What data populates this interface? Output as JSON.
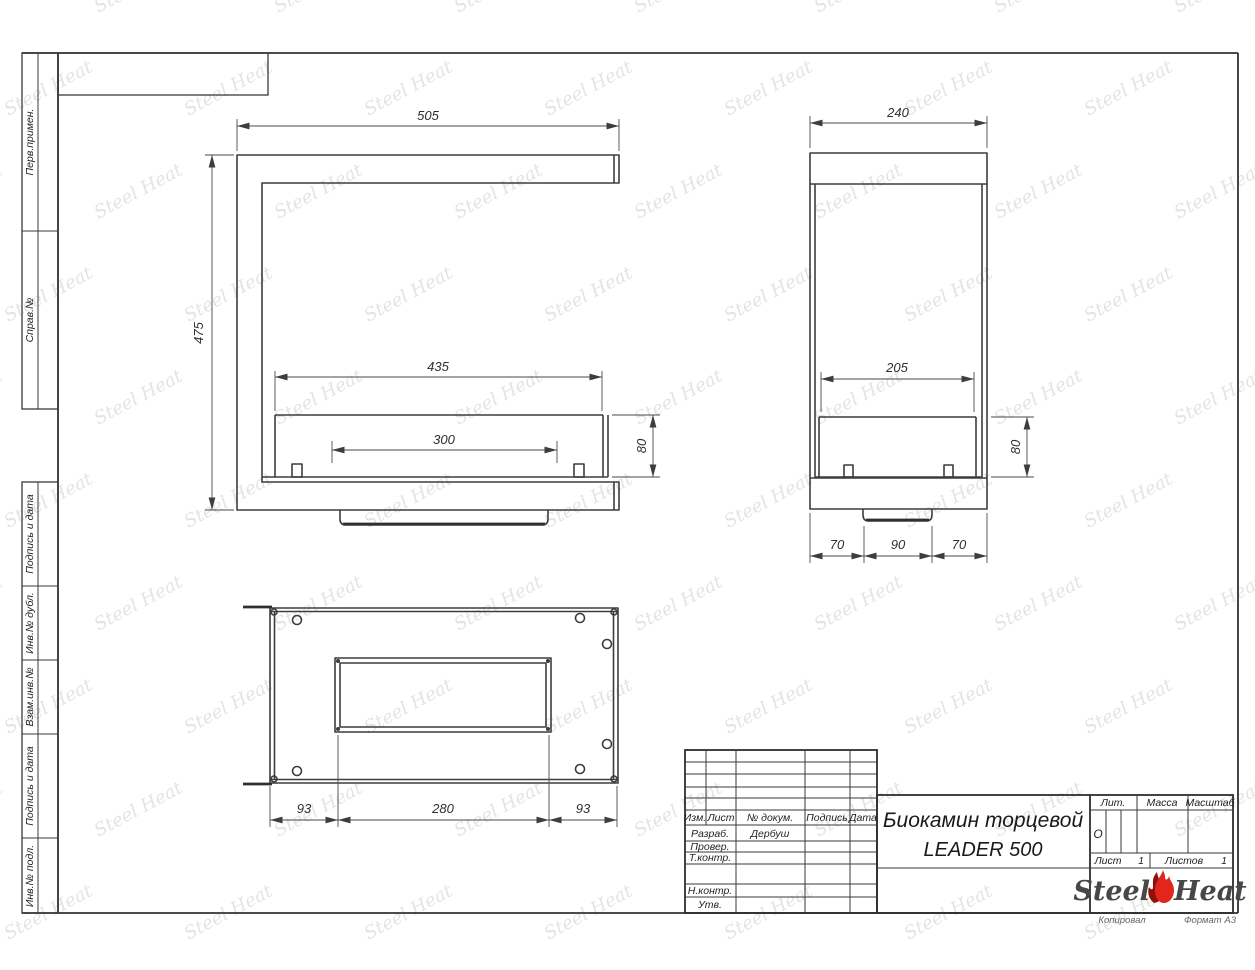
{
  "sheet": {
    "watermark_text": "Steel Heat",
    "copied_label": "Копировал",
    "format_label": "Формат А3"
  },
  "left_strip": {
    "cells": [
      {
        "label": "Перв.примен."
      },
      {
        "label": "Справ.№"
      },
      {
        "label": "Подпись и дата"
      },
      {
        "label": "Инв.№ дубл."
      },
      {
        "label": "Взам.инв.№"
      },
      {
        "label": "Подпись и дата"
      },
      {
        "label": "Инв.№ подл."
      }
    ]
  },
  "title_block": {
    "title_line1": "Биокамин торцевой",
    "title_line2": "LEADER 500",
    "columns": {
      "izm": "Изм.",
      "list": "Лист",
      "doc": "№ докум.",
      "sign": "Подпись",
      "date": "Дата"
    },
    "roles": {
      "developed_label": "Разраб.",
      "developed_value": "Дербуш",
      "checked_label": "Провер.",
      "tcontrol_label": "Т.контр.",
      "ncontrol_label": "Н.контр.",
      "approved_label": "Утв."
    },
    "lit_label": "Лит.",
    "lit_value": "О",
    "mass_label": "Масса",
    "scale_label": "Масштаб",
    "sheet_label": "Лист",
    "sheet_number": "1",
    "sheets_label": "Листов",
    "sheets_total": "1",
    "brand_steel": "Steel",
    "brand_heat": "Heat"
  },
  "dimensions": {
    "front": {
      "width": "505",
      "height": "475",
      "glass_width": "435",
      "burner_width": "300",
      "glass_height": "80"
    },
    "side": {
      "depth": "240",
      "glass_width": "205",
      "glass_height": "80",
      "base_left": "70",
      "base_center": "90",
      "base_right": "70"
    },
    "top": {
      "margin_left": "93",
      "opening_width": "280",
      "margin_right": "93"
    }
  }
}
